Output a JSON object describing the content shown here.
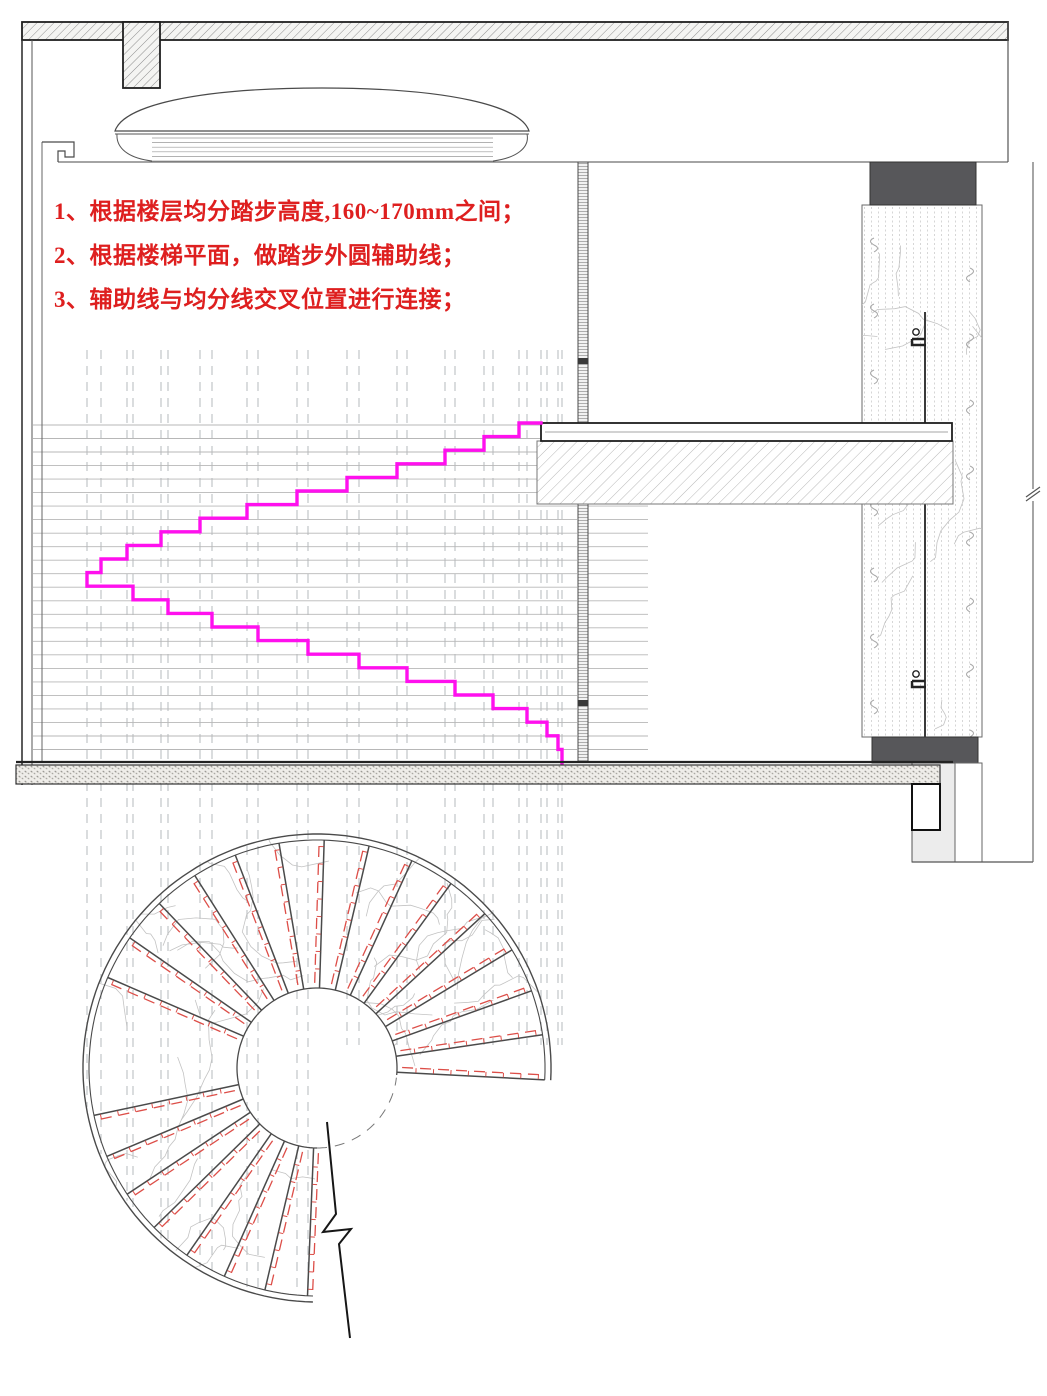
{
  "notes": {
    "color": "#de1f1f",
    "items": [
      "1、根据楼层均分踏步高度,160~170mm之间；",
      "2、根据楼梯平面，做踏步外圆辅助线；",
      "3、辅助线与均分线交叉位置进行连接；"
    ]
  },
  "drawing": {
    "colors": {
      "outline": "#1f1f1f",
      "medium": "#4a4a4a",
      "light_line": "#b7b7b7",
      "guide_dash": "#c2c6c9",
      "stair_profile_magenta": "#ff10ee",
      "aux_red": "#dd4e48",
      "dark_fill": "#57575a",
      "hatch": "#8f8f8f",
      "vein": "#c3c3c3"
    },
    "section": {
      "top_slab": {
        "x": 22,
        "y": 22,
        "w": 986,
        "h": 18
      },
      "hanger_stub": {
        "x": 123,
        "y": 22,
        "w": 37,
        "h": 66
      },
      "left_wall": {
        "x1": 22,
        "x2": 32,
        "face_x": 42,
        "top": 40,
        "bottom": 785
      },
      "ceiling_y": 162,
      "cornice": {
        "path_x": [
          42,
          74,
          74,
          65,
          65,
          58,
          58
        ],
        "path_y": [
          142,
          142,
          157,
          157,
          151,
          151,
          162
        ]
      },
      "dome": {
        "x1": 115,
        "x2": 529,
        "top_y": 88,
        "shelf_y": 131,
        "base_bottom": 162,
        "ring_x1": 152,
        "ring_x2": 493
      },
      "mullion": {
        "x": 578,
        "w": 10,
        "top": 162,
        "bottom": 762,
        "joints": [
          361,
          703
        ]
      },
      "column": {
        "shaft_x": 862,
        "shaft_w": 120,
        "shaft_top": 205,
        "shaft_bottom": 737,
        "cap_x": 870,
        "cap_w": 106,
        "cap_top": 162,
        "base_x": 872,
        "base_w": 106,
        "base_bottom": 763,
        "rod_x": 925,
        "rod_top": 312,
        "bolts": [
          334,
          676
        ]
      },
      "mid_slab": {
        "x": 541,
        "y": 423,
        "w": 412,
        "strip_h": 18,
        "h": 81
      },
      "floor": {
        "y": 762,
        "band_top": 765,
        "band_bottom": 784,
        "x1": 16,
        "x2": 953,
        "band_x2": 940
      },
      "pit": {
        "gray": {
          "x": 912,
          "y": 763,
          "w": 43,
          "h": 99
        },
        "pocket": {
          "x": 912,
          "y": 784,
          "w": 28,
          "h": 46
        },
        "strip": {
          "x": 955,
          "y": 763,
          "w": 27,
          "h": 99
        },
        "bottom_y": 862,
        "right_x": 1033,
        "break_y": 495
      },
      "right_edge_top": {
        "x": 1008,
        "y1": 22,
        "y2": 162
      },
      "stair_profile": {
        "top_y": 423,
        "floor_y": 763,
        "risers": 25,
        "upper_flight_x": [
          541,
          519,
          484,
          445,
          397,
          347,
          297,
          247,
          200,
          161,
          127,
          101,
          87
        ],
        "lower_flight_x": [
          87,
          133,
          168,
          212,
          258,
          308,
          359,
          407,
          455,
          493,
          527,
          547,
          558,
          562
        ]
      },
      "division_lines": {
        "x1": 33,
        "x2": 577,
        "xb1": 588,
        "xb2": 648,
        "top": 425,
        "step": 13.52,
        "count": 25
      },
      "guides": {
        "top": 350,
        "right_bottom": 1045,
        "max_bottom": 1292
      }
    },
    "plan": {
      "cx": 317,
      "cy": 1068,
      "r_outer": 234,
      "r_outer2": 228,
      "r_inner": 80,
      "arc_start": -3,
      "arc_end": 269,
      "tread_fans": [
        {
          "start": -3,
          "step": 11.4,
          "count": 15
        },
        {
          "start": 192,
          "step": 10.8,
          "count": 8
        }
      ],
      "inner_dash_start": 270,
      "inner_dash_end": 353,
      "break_line": [
        [
          327,
          1122
        ],
        [
          336,
          1214
        ],
        [
          323,
          1232
        ],
        [
          351,
          1229
        ],
        [
          339,
          1244
        ],
        [
          350,
          1338
        ]
      ]
    }
  }
}
